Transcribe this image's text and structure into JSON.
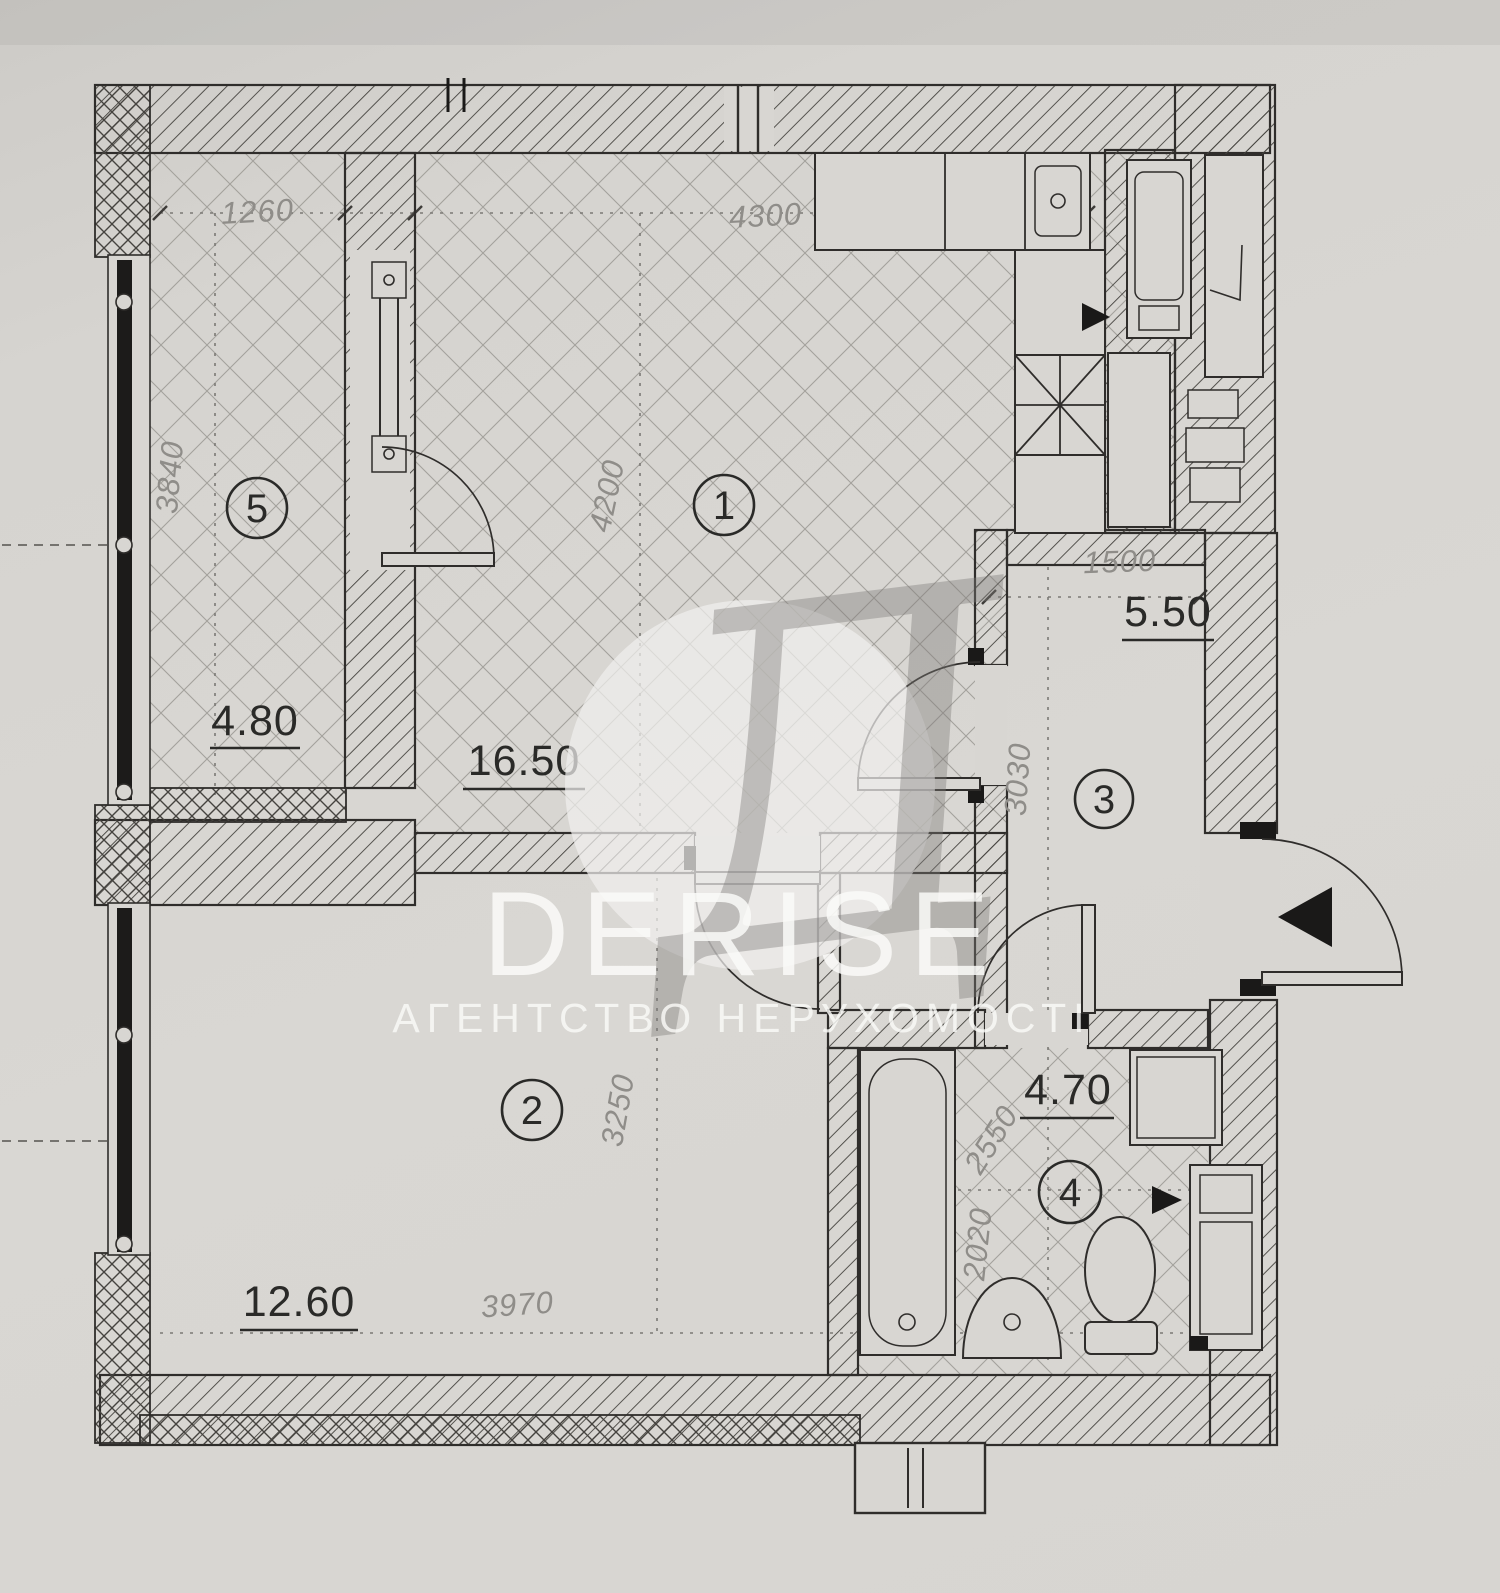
{
  "watermark": {
    "letter": "Д",
    "brand": "DERISE",
    "subtitle": "АГЕНТСТВО НЕРУХОМОСТІ"
  },
  "rooms": [
    {
      "number": "1",
      "area": "16.50"
    },
    {
      "number": "2",
      "area": "12.60"
    },
    {
      "number": "3",
      "area": "5.50"
    },
    {
      "number": "4",
      "area": "4.70"
    },
    {
      "number": "5",
      "area": "4.80"
    }
  ],
  "dimensions": {
    "balcony_width": "1260",
    "top_width": "4300",
    "balcony_depth": "3840",
    "room1_depth": "4200",
    "hall_width": "1500",
    "hall_depth": "3030",
    "room2_depth": "3250",
    "room2_width": "3970",
    "bath_width": "2550",
    "bath_depth": "2020"
  }
}
